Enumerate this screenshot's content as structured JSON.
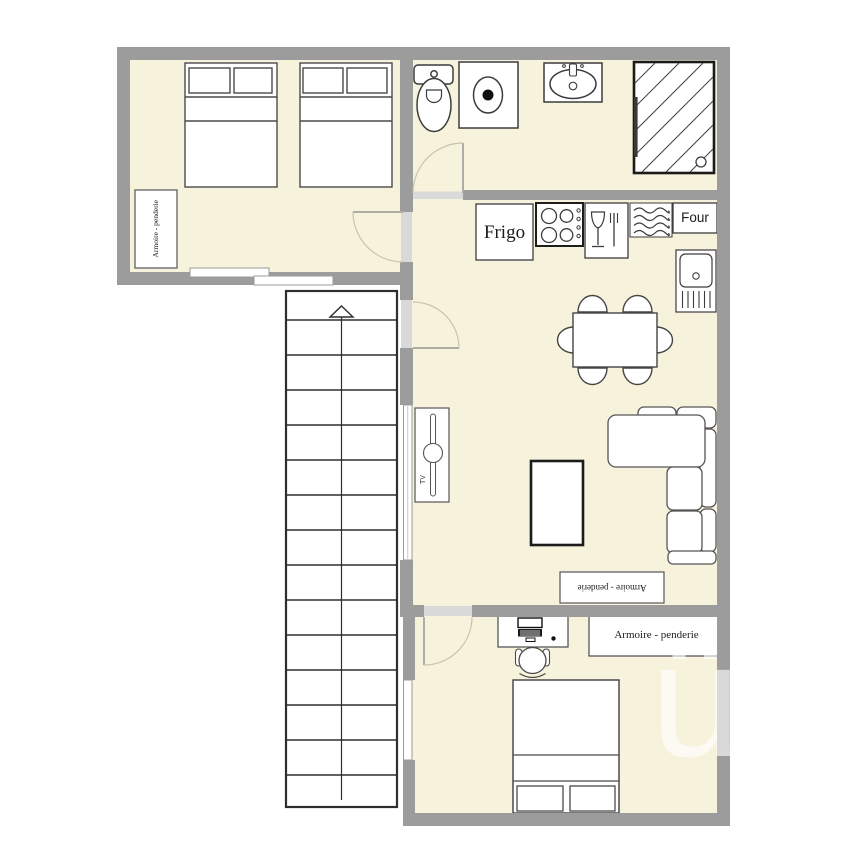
{
  "labels": {
    "fridge": "Frigo",
    "oven": "Four",
    "wardrobe_top": "Armoire - penderie",
    "wardrobe_living": "Armoire - penderie",
    "wardrobe_bottom": "Armoire - penderie",
    "tv": "TV",
    "watermark": "ü"
  },
  "colors": {
    "background": "#ffffff",
    "floor": "#f7f2dc",
    "wall": "#9c9c9c",
    "door_sill": "#d9d9d9",
    "window": "#ffffff",
    "furniture_outline": "#444444",
    "stairs_outline": "#2e2e2e",
    "door_arc": "#c9c3ae",
    "computer_dark": "#1a1a1a"
  },
  "stairs": {
    "steps": 15,
    "direction": "up-arrow"
  },
  "icons": {
    "bathroom": [
      "toilet-icon",
      "washing-machine-icon",
      "sink-icon",
      "shower-icon"
    ],
    "kitchen": [
      "stove-icon",
      "dishwasher-icon",
      "radiator-icon",
      "kitchen-sink-icon"
    ],
    "living": [
      "tv-icon"
    ],
    "bedroom_bottom": [
      "computer-icon"
    ],
    "stairs": [
      "up-arrow-icon"
    ]
  },
  "rooms": {
    "bedroom_top": {
      "furniture": [
        "double bed",
        "double bed",
        "wardrobe"
      ]
    },
    "bathroom": {
      "furniture": [
        "toilet",
        "washing machine",
        "sink",
        "shower"
      ]
    },
    "kitchen_living": {
      "furniture": [
        "fridge",
        "stove",
        "dishwasher",
        "radiator",
        "oven",
        "kitchen sink",
        "dining table",
        "6 chairs",
        "corner sofa",
        "coffee table",
        "tv stand",
        "wardrobe"
      ]
    },
    "bedroom_bottom": {
      "furniture": [
        "desk",
        "desk chair",
        "computer",
        "wardrobe",
        "double bed"
      ]
    }
  }
}
